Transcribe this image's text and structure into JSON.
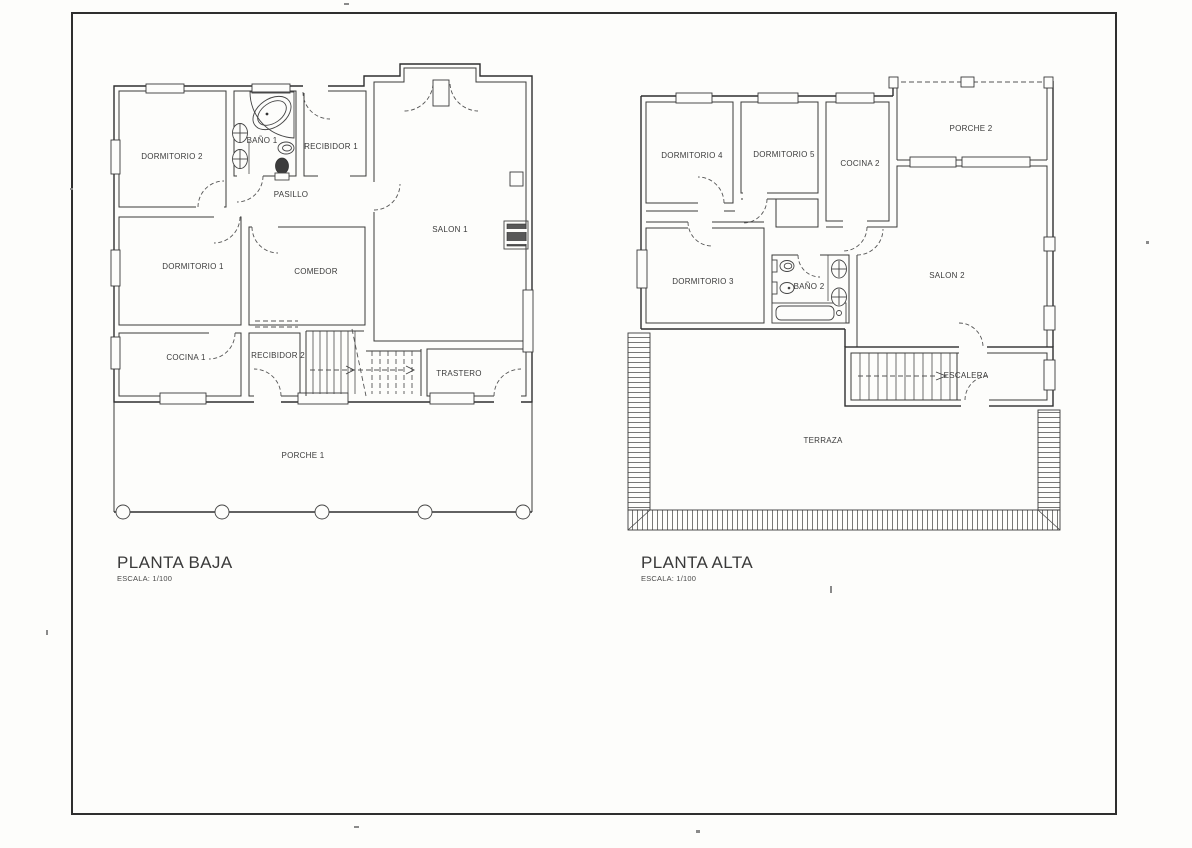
{
  "sheet": {
    "paper_color": "#fdfdfb",
    "ink_color": "#3a3a3a"
  },
  "plans": [
    {
      "title": "PLANTA BAJA",
      "scale_label": "ESCALA: 1/100",
      "rooms": [
        "DORMITORIO 2",
        "BAÑO 1",
        "RECIBIDOR 1",
        "PASILLO",
        "SALON 1",
        "DORMITORIO 1",
        "COMEDOR",
        "COCINA 1",
        "RECIBIDOR 2",
        "TRASTERO",
        "PORCHE 1"
      ],
      "fixture_icons": [
        "corner-bathtub-icon",
        "washbasin-icon",
        "washbasin-icon",
        "bidet-icon",
        "toilet-icon",
        "fireplace-icon",
        "staircase-icon",
        "stair-direction-arrow-icon",
        "double-entry-door-icon",
        "porch-column-icon"
      ]
    },
    {
      "title": "PLANTA ALTA",
      "scale_label": "ESCALA: 1/100",
      "rooms": [
        "DORMITORIO 4",
        "DORMITORIO 5",
        "COCINA 2",
        "PORCHE 2",
        "DORMITORIO 3",
        "BAÑO 2",
        "SALON 2",
        "ESCALERA",
        "TERRAZA"
      ],
      "fixture_icons": [
        "toilet-icon",
        "bidet-icon",
        "bathtub-icon",
        "washbasin-icon",
        "washbasin-icon",
        "staircase-icon",
        "stair-direction-arrow-icon",
        "terrace-roof-hatch-icon",
        "porch-roof-dashed-icon"
      ]
    }
  ]
}
